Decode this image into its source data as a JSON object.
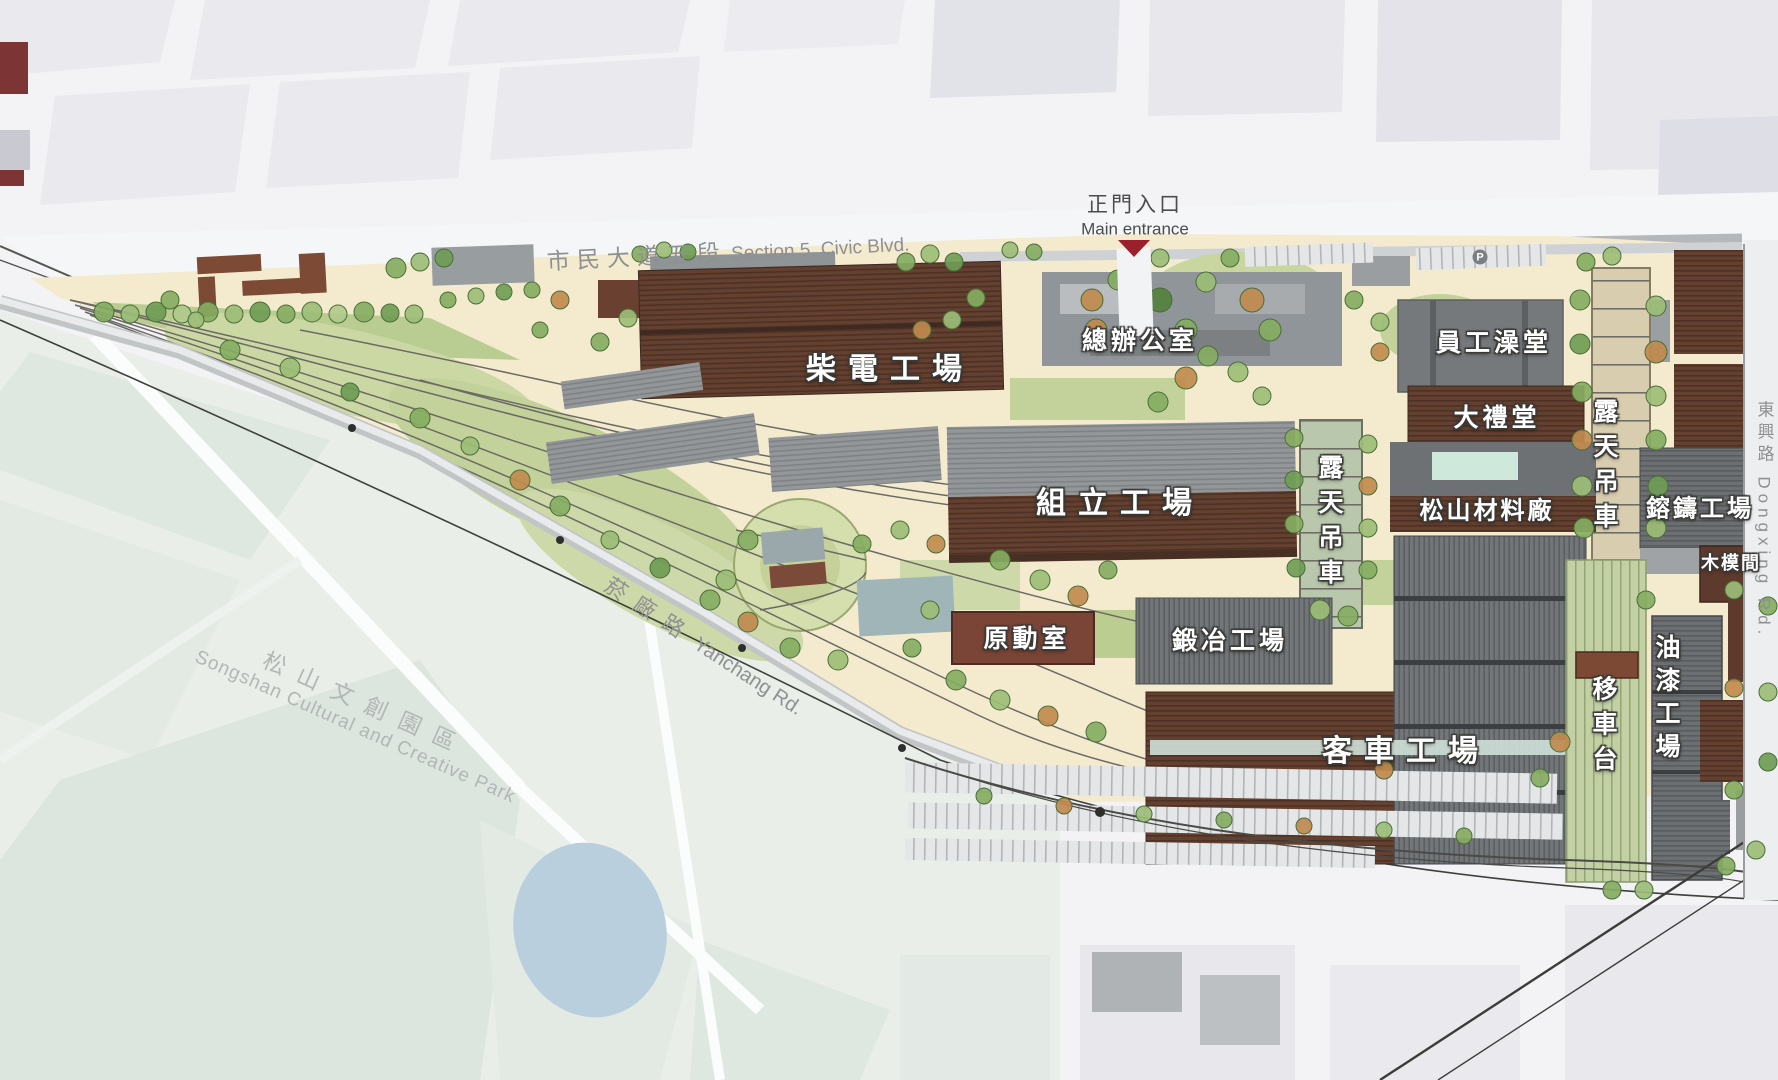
{
  "map": {
    "entrance": {
      "zh": "正門入口",
      "en": "Main entrance"
    },
    "roads": {
      "civic_zh": "市民大道五段",
      "civic_en": "Section 5, Civic Blvd.",
      "yanchang_zh": "菸廠路",
      "yanchang_en": "Yanchang Rd.",
      "dongxing_zh": "東興路",
      "dongxing_en": "Dongxing Rd."
    },
    "district": {
      "zh": "松山文創園區",
      "en": "Songshan Cultural and Creative Park"
    },
    "parking_symbol": "P",
    "buildings": [
      {
        "id": "diesel-workshop",
        "label": "柴電工場"
      },
      {
        "id": "general-office",
        "label": "總辦公室"
      },
      {
        "id": "employee-bathhouse",
        "label": "員工澡堂"
      },
      {
        "id": "auditorium",
        "label": "大禮堂"
      },
      {
        "id": "assembly-workshop",
        "label": "組立工場"
      },
      {
        "id": "open-air-crane-center",
        "label": "露天吊車"
      },
      {
        "id": "songshan-material-depot",
        "label": "松山材料廠"
      },
      {
        "id": "open-air-crane-east",
        "label": "露天吊車"
      },
      {
        "id": "casting-workshop",
        "label": "鎔鑄工場"
      },
      {
        "id": "wood-mold-room",
        "label": "木模間"
      },
      {
        "id": "power-room",
        "label": "原動室"
      },
      {
        "id": "forging-workshop",
        "label": "鍛冶工場"
      },
      {
        "id": "passenger-car-workshop",
        "label": "客車工場"
      },
      {
        "id": "traverser",
        "label": "移車台"
      },
      {
        "id": "paint-workshop",
        "label": "油漆工場"
      }
    ],
    "colors": {
      "entrance_marker": "#9c1f2e",
      "site_ground": "#f4ebcf",
      "building_brown": "#63402f",
      "building_gray": "#909496",
      "lawn": "#c9d6a0",
      "pond": "#b9cfdd"
    }
  }
}
